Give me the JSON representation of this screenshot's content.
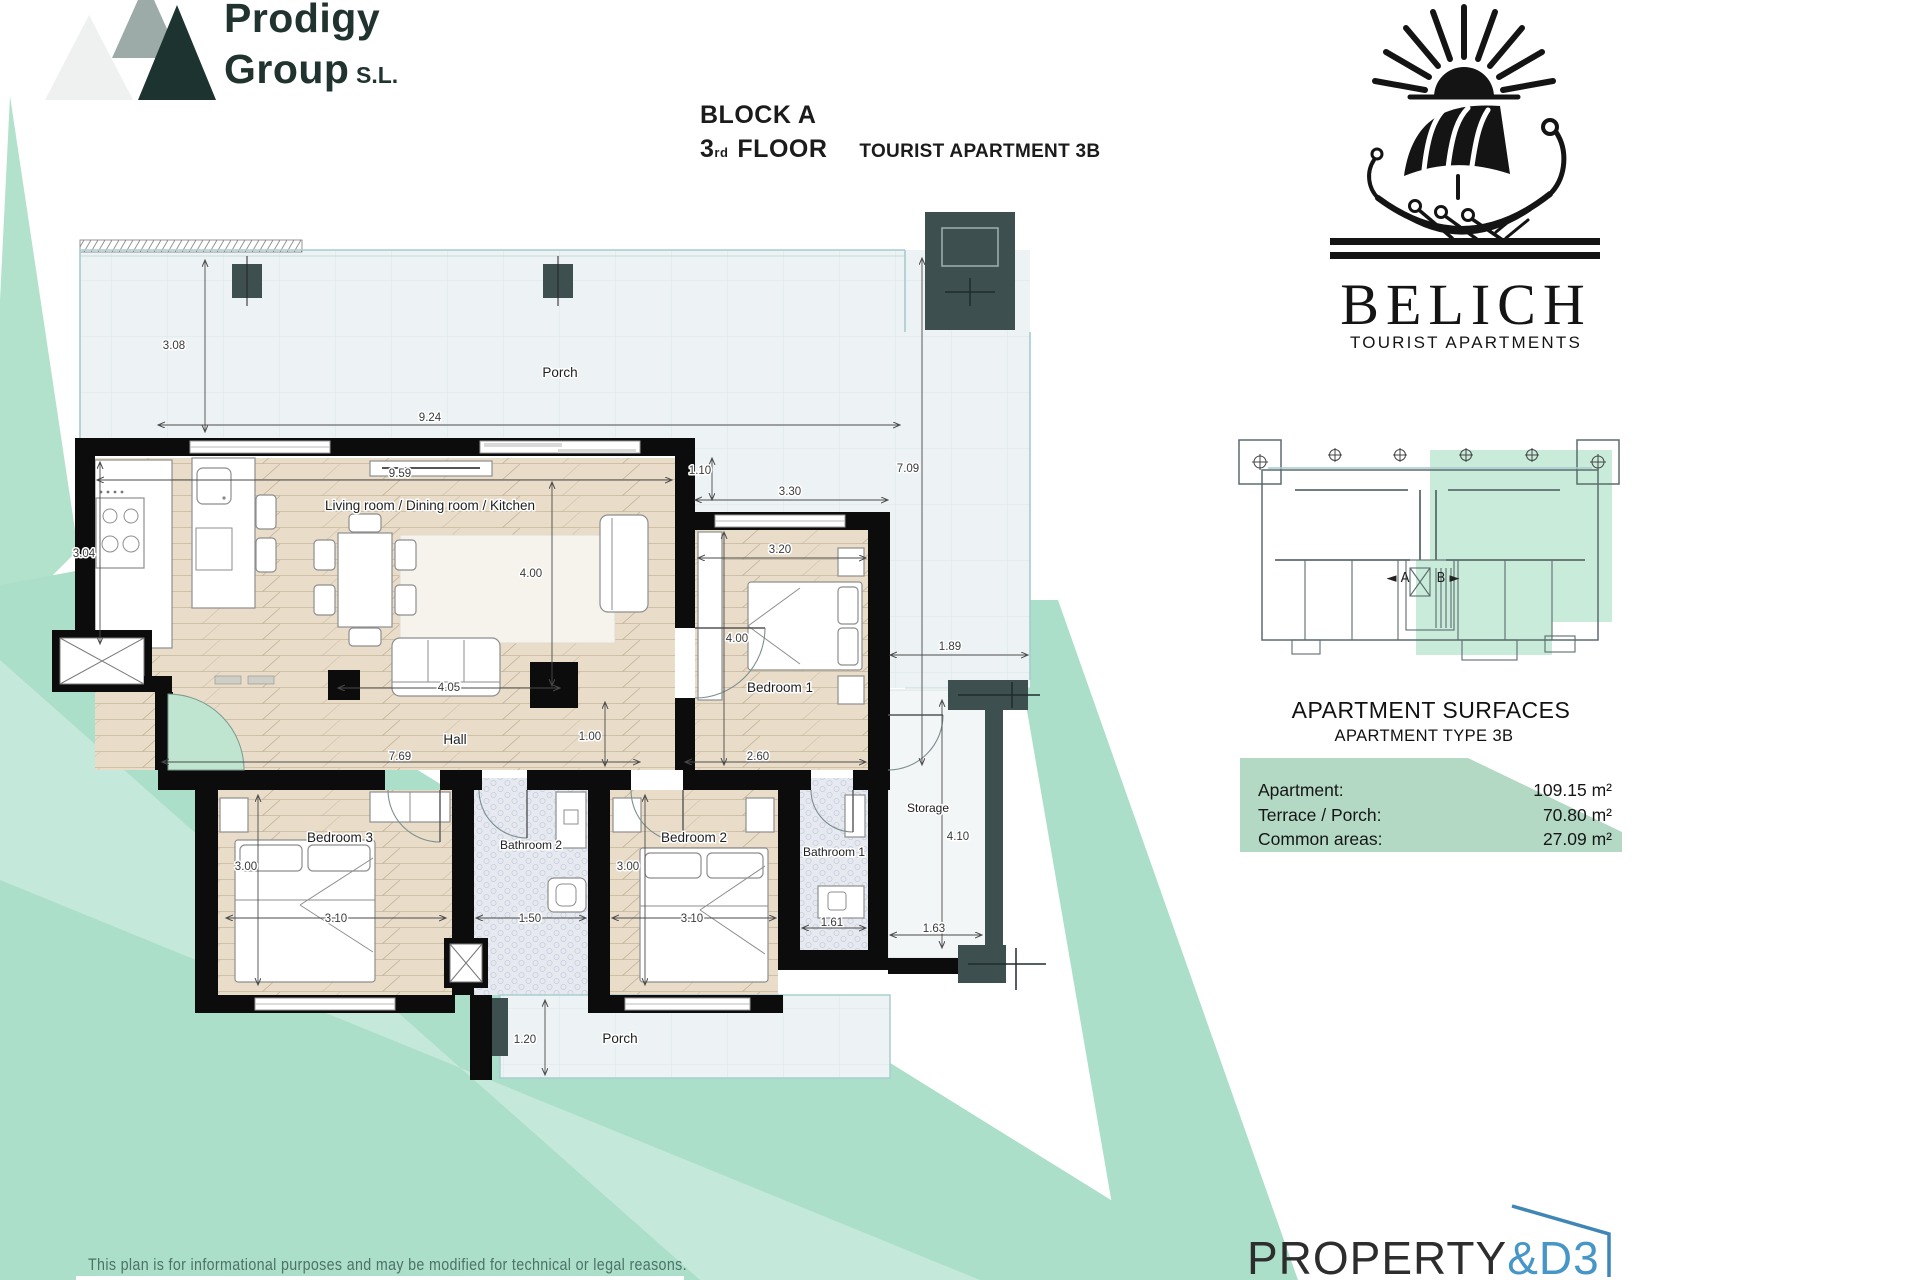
{
  "branding": {
    "prodigy": {
      "word1": "Prodigy",
      "word2": "Group",
      "suffix": "S.L."
    },
    "belich": {
      "name": "BELICH",
      "tagline": "TOURIST APARTMENTS"
    },
    "property": {
      "part1": "PROPERTY",
      "part2": "&D3"
    }
  },
  "header": {
    "block": "BLOCK A",
    "floor_number": "3",
    "floor_ordinal": "rd",
    "floor_word": "FLOOR",
    "unit": "TOURIST APARTMENT 3B"
  },
  "plan": {
    "rooms": {
      "porch_top": "Porch",
      "living": "Living room / Dining room / Kitchen",
      "bedroom1": "Bedroom 1",
      "bedroom2": "Bedroom 2",
      "bedroom3": "Bedroom 3",
      "bathroom1": "Bathroom 1",
      "bathroom2": "Bathroom 2",
      "hall": "Hall",
      "storage": "Storage",
      "porch_bottom": "Porch"
    },
    "dims": {
      "porch_height": "3.08",
      "porch_width": "9.24",
      "living_width": "9.59",
      "kitchen_depth": "3.04",
      "living_depth": "4.00",
      "sofa_width": "4.05",
      "bedroom1_offset": "1.10",
      "bedroom1_outer": "3.30",
      "bedroom1_width": "3.20",
      "bedroom1_depth": "4.00",
      "terrace_right_height": "7.09",
      "terrace_right_width": "1.89",
      "hall_width": "7.69",
      "hall_depth": "1.00",
      "hall_right": "2.60",
      "bedroom3_depth": "3.00",
      "bedroom3_width": "3.10",
      "bathroom2_width": "1.50",
      "bedroom2_depth": "3.00",
      "bedroom2_width": "3.10",
      "bathroom1_width": "1.61",
      "storage_width": "1.63",
      "storage_height": "4.10",
      "porch_bottom_depth": "1.20"
    }
  },
  "overview": {
    "label_a": "◄ A",
    "label_b": "B ►"
  },
  "surfaces": {
    "title": "APARTMENT SURFACES",
    "subtitle": "APARTMENT TYPE 3B",
    "rows": [
      {
        "label": "Apartment:",
        "value": "109.15 m²"
      },
      {
        "label": "Terrace / Porch:",
        "value": "70.80 m²"
      },
      {
        "label": "Common areas:",
        "value": "27.09 m²"
      }
    ]
  },
  "disclaimer": "This plan is for informational purposes and may be modified for technical or legal reasons.",
  "colors": {
    "mint": "#abdfc9",
    "panel_green": "#b3d9c5",
    "slate": "#3e4f50",
    "brand_blue": "#4796c8",
    "wall_black": "#0c0c0c"
  }
}
